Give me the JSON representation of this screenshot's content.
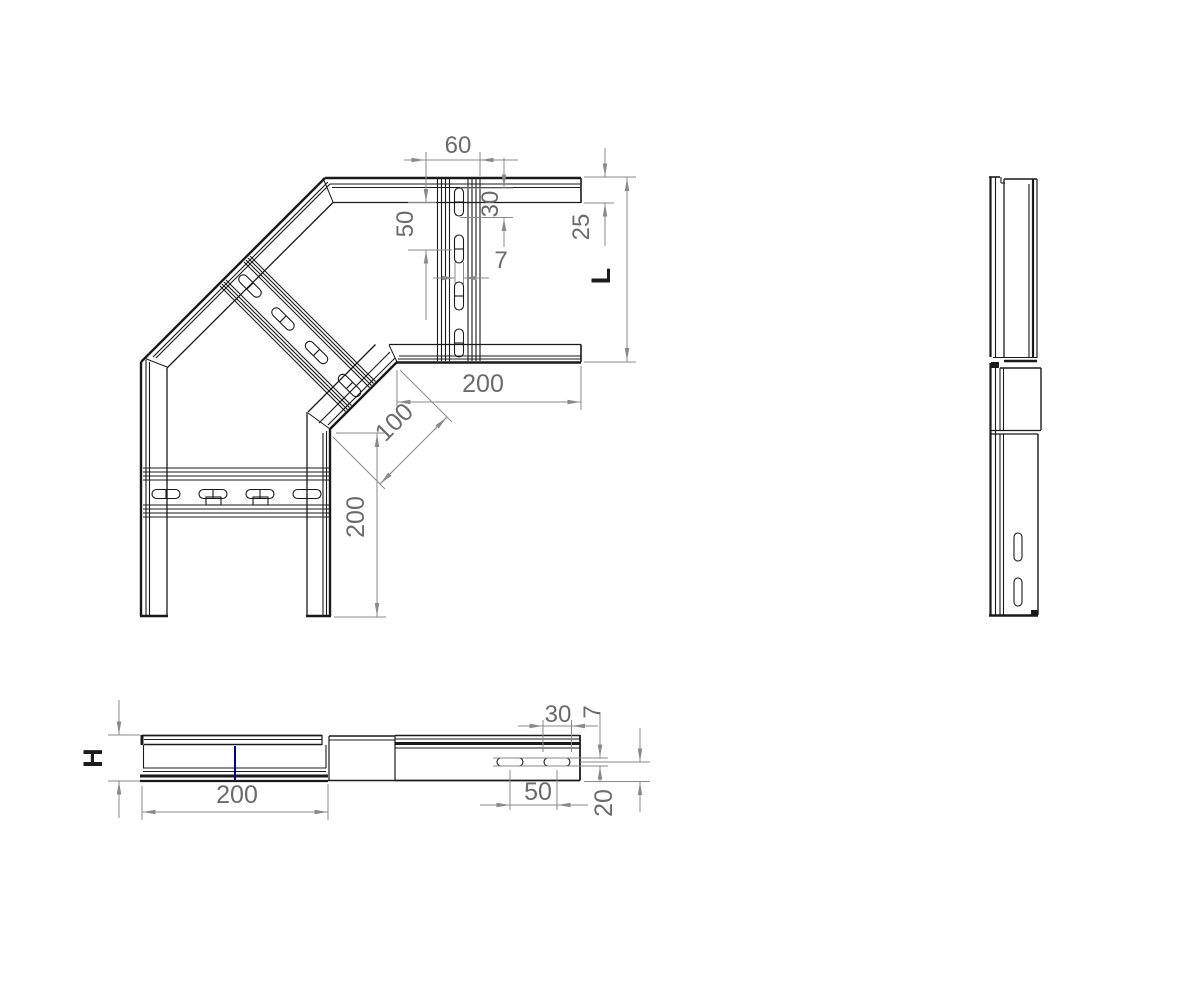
{
  "drawing": {
    "kind": "cad-orthographic-views",
    "views": {
      "plan": {
        "dims": {
          "rung_width": "60",
          "slot_length": "30",
          "slot_pitch": "50",
          "slot_width": "7",
          "flange_width": "25",
          "overall_width": "L",
          "arm_length_horizontal": "200",
          "miter_face": "100",
          "arm_length_vertical": "200"
        }
      },
      "bottom": {
        "dims": {
          "height": "H",
          "section_length": "200",
          "slot_length": "30",
          "slot_width": "7",
          "slot_pitch": "50",
          "slot_offset": "20"
        }
      }
    },
    "colors": {
      "outline": "#1a1a1a",
      "dimension": "#8a8a8a",
      "dimension_text": "#6b6b6b",
      "accent": "#00008b",
      "background": "#ffffff"
    }
  }
}
